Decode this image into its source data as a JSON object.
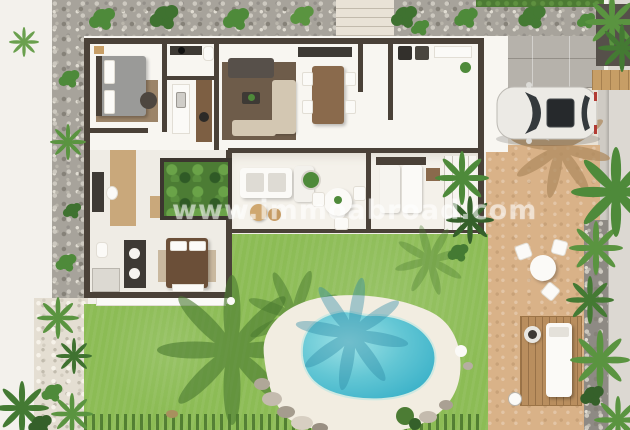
{
  "watermark": {
    "text": "www.immoabroad.com"
  },
  "colors": {
    "background": "#f3f1ec",
    "gravel": "#a7a39b",
    "gravel_light": "#e4ded2",
    "hedge": "#4c7a33",
    "lawn": "#8cbc55",
    "lawn_shadow": "#4a7a30",
    "pool_light": "#9fe2e6",
    "pool_dark": "#3cb2c9",
    "coping": "#f2ede1",
    "sand": "#d9b288",
    "deck_wood": "#b98e5e",
    "pavers": "#b6b2ab",
    "paving": "#e9e2d6",
    "wall": "#4a4138",
    "roof_white": "#f8f6f1",
    "interior_floor": "#efece5",
    "rug_runner": "#c9a87b",
    "rug_living": "#6e5c4a",
    "plant_green": "#4e8a3a",
    "plant_dark": "#35602a",
    "tan_wall": "#c79e66",
    "car_body": "#eceae5",
    "car_glass": "#34393c",
    "bed_blanket": "#6b4f38",
    "sofa_beige": "#d3c7b2",
    "sofa_dark": "#57504a",
    "dining_wood": "#8a6a4c"
  },
  "scene": {
    "type": "3d-floor-plan-render",
    "areas": [
      "gravel-border",
      "master-bedroom",
      "bathroom-1",
      "kitchen",
      "living-room",
      "dining-area",
      "entry-hall",
      "laundry-room",
      "corridor",
      "inner-patio",
      "bathroom-2",
      "bedroom-2",
      "covered-terrace",
      "bedroom-3",
      "wardrobe",
      "garden-lawn",
      "swimming-pool",
      "rock-feature",
      "wooden-deck",
      "outdoor-lounge",
      "bistro-set",
      "sun-deck",
      "driveway",
      "parked-car",
      "palm-trees",
      "planter",
      "entrance-path"
    ]
  }
}
